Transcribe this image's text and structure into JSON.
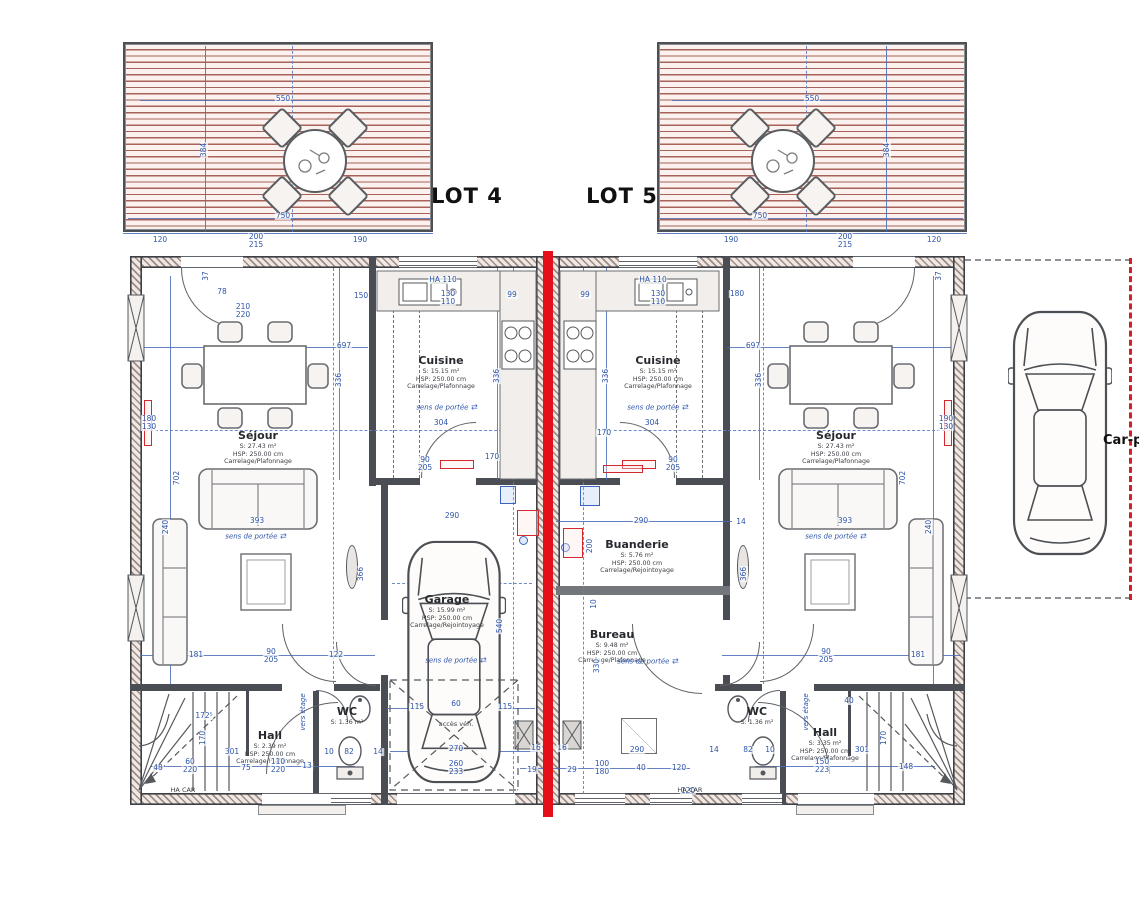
{
  "lots": [
    {
      "label": "LOT 4",
      "x": 467,
      "y": 196
    },
    {
      "label": "LOT 5",
      "x": 622,
      "y": 196
    }
  ],
  "carport": {
    "label": "Car-p",
    "x": 1103,
    "y": 433
  },
  "rooms": [
    {
      "name": "Séjour",
      "lines": [
        "S: 27.43 m²",
        "HSP: 250.00 cm",
        "Carrelage/Plafonnage"
      ],
      "x": 258,
      "y": 448
    },
    {
      "name": "Cuisine",
      "lines": [
        "S: 15.15 m²",
        "HSP: 250.00 cm",
        "Carrelage/Plafonnage"
      ],
      "x": 441,
      "y": 373
    },
    {
      "name": "Garage",
      "lines": [
        "S: 15.99 m²",
        "HSP: 250.00 cm",
        "Carrelage/Rejointoyage"
      ],
      "x": 447,
      "y": 612
    },
    {
      "name": "Hall",
      "lines": [
        "S: 2.39 m²",
        "HSP: 250.00 cm",
        "Carrelage/Plafonnage"
      ],
      "x": 270,
      "y": 748
    },
    {
      "name": "WC",
      "lines": [
        "S: 1.36 m²"
      ],
      "x": 347,
      "y": 716
    },
    {
      "name": "Cuisine",
      "lines": [
        "S: 15.15 m²",
        "HSP: 250.00 cm",
        "Carrelage/Plafonnage"
      ],
      "x": 658,
      "y": 373
    },
    {
      "name": "Buanderie",
      "lines": [
        "S: 5.76 m²",
        "HSP: 250.00 cm",
        "Carrelage/Rejointoyage"
      ],
      "x": 637,
      "y": 557
    },
    {
      "name": "Bureau",
      "lines": [
        "S: 9.48 m²",
        "HSP: 250.00 cm",
        "Carrelage/Plafonnage"
      ],
      "x": 612,
      "y": 647
    },
    {
      "name": "Séjour",
      "lines": [
        "S: 27.43 m²",
        "HSP: 250.00 cm",
        "Carrelage/Plafonnage"
      ],
      "x": 836,
      "y": 448
    },
    {
      "name": "WC",
      "lines": [
        "S: 1.36 m²"
      ],
      "x": 757,
      "y": 716
    },
    {
      "name": "Hall",
      "lines": [
        "S: 3.35 m²",
        "HSP: 250.00 cm",
        "Carrelage/Plafonnage"
      ],
      "x": 825,
      "y": 745
    }
  ],
  "dimensions": [
    {
      "t": "550",
      "x": 283,
      "y": 99
    },
    {
      "t": "750",
      "x": 283,
      "y": 216
    },
    {
      "t": "384",
      "x": 204,
      "y": 150,
      "v": 1
    },
    {
      "t": "120",
      "x": 160,
      "y": 240
    },
    {
      "t": "200",
      "t2": "215",
      "x": 256,
      "y": 241
    },
    {
      "t": "190",
      "x": 360,
      "y": 240
    },
    {
      "t": "550",
      "x": 812,
      "y": 99
    },
    {
      "t": "750",
      "x": 760,
      "y": 216
    },
    {
      "t": "384",
      "x": 887,
      "y": 150,
      "v": 1
    },
    {
      "t": "190",
      "x": 731,
      "y": 240
    },
    {
      "t": "200",
      "t2": "215",
      "x": 845,
      "y": 241
    },
    {
      "t": "120",
      "x": 934,
      "y": 240
    },
    {
      "t": "697",
      "x": 344,
      "y": 346
    },
    {
      "t": "697",
      "x": 753,
      "y": 346
    },
    {
      "t": "336",
      "x": 339,
      "y": 380,
      "v": 1
    },
    {
      "t": "336",
      "x": 497,
      "y": 376,
      "v": 1
    },
    {
      "t": "336",
      "x": 606,
      "y": 376,
      "v": 1
    },
    {
      "t": "336",
      "x": 759,
      "y": 380,
      "v": 1
    },
    {
      "t": "304",
      "x": 441,
      "y": 423
    },
    {
      "t": "304",
      "x": 652,
      "y": 423
    },
    {
      "t": "702",
      "x": 177,
      "y": 478,
      "v": 1
    },
    {
      "t": "702",
      "x": 903,
      "y": 478,
      "v": 1
    },
    {
      "t": "393",
      "x": 257,
      "y": 521
    },
    {
      "t": "393",
      "x": 845,
      "y": 521
    },
    {
      "t": "240",
      "x": 166,
      "y": 527,
      "v": 1
    },
    {
      "t": "240",
      "x": 929,
      "y": 527,
      "v": 1
    },
    {
      "t": "180",
      "t2": "130",
      "x": 149,
      "y": 423
    },
    {
      "t": "190",
      "t2": "130",
      "x": 946,
      "y": 423
    },
    {
      "t": "90",
      "t2": "205",
      "x": 271,
      "y": 656
    },
    {
      "t": "122",
      "x": 336,
      "y": 655
    },
    {
      "t": "181",
      "x": 196,
      "y": 655
    },
    {
      "t": "90",
      "t2": "205",
      "x": 826,
      "y": 656
    },
    {
      "t": "181",
      "x": 918,
      "y": 655
    },
    {
      "t": "290",
      "x": 452,
      "y": 516
    },
    {
      "t": "290",
      "x": 641,
      "y": 521
    },
    {
      "t": "540",
      "x": 500,
      "y": 626,
      "v": 1
    },
    {
      "t": "330",
      "x": 597,
      "y": 666,
      "v": 1
    },
    {
      "t": "115",
      "x": 417,
      "y": 707
    },
    {
      "t": "60",
      "x": 456,
      "y": 704
    },
    {
      "t": "115",
      "x": 505,
      "y": 707
    },
    {
      "t": "270",
      "x": 456,
      "y": 749
    },
    {
      "t": "260",
      "t2": "233",
      "x": 456,
      "y": 768
    },
    {
      "t": "16",
      "x": 536,
      "y": 748
    },
    {
      "t": "16",
      "x": 562,
      "y": 748
    },
    {
      "t": "19",
      "x": 532,
      "y": 770
    },
    {
      "t": "29",
      "x": 572,
      "y": 770
    },
    {
      "t": "100",
      "t2": "180",
      "x": 602,
      "y": 768
    },
    {
      "t": "40",
      "x": 641,
      "y": 768
    },
    {
      "t": "120",
      "x": 679,
      "y": 768
    },
    {
      "t": "290",
      "x": 637,
      "y": 750
    },
    {
      "t": "301",
      "x": 232,
      "y": 752
    },
    {
      "t": "110",
      "t2": "220",
      "x": 278,
      "y": 766
    },
    {
      "t": "75",
      "x": 246,
      "y": 768
    },
    {
      "t": "13",
      "x": 307,
      "y": 766
    },
    {
      "t": "10",
      "x": 329,
      "y": 752
    },
    {
      "t": "82",
      "x": 349,
      "y": 752
    },
    {
      "t": "14",
      "x": 378,
      "y": 752
    },
    {
      "t": "40",
      "x": 849,
      "y": 701
    },
    {
      "t": "301",
      "x": 862,
      "y": 750
    },
    {
      "t": "150",
      "t2": "223",
      "x": 822,
      "y": 766
    },
    {
      "t": "148",
      "x": 906,
      "y": 767
    },
    {
      "t": "14",
      "x": 714,
      "y": 750
    },
    {
      "t": "82",
      "x": 748,
      "y": 750
    },
    {
      "t": "10",
      "x": 770,
      "y": 750
    },
    {
      "t": "170",
      "x": 884,
      "y": 738,
      "v": 1
    },
    {
      "t": "170",
      "x": 203,
      "y": 738,
      "v": 1
    },
    {
      "t": "172⁵",
      "x": 204,
      "y": 716
    },
    {
      "t": "37",
      "x": 206,
      "y": 276,
      "v": 1
    },
    {
      "t": "37",
      "x": 939,
      "y": 276,
      "v": 1
    },
    {
      "t": "78",
      "x": 222,
      "y": 292
    },
    {
      "t": "210",
      "t2": "220",
      "x": 243,
      "y": 311
    },
    {
      "t": "150",
      "x": 361,
      "y": 296
    },
    {
      "t": "130",
      "t2": "110",
      "x": 448,
      "y": 298
    },
    {
      "t": "HA 110",
      "x": 443,
      "y": 280
    },
    {
      "t": "HA 110",
      "x": 653,
      "y": 280
    },
    {
      "t": "130",
      "t2": "110",
      "x": 658,
      "y": 298
    },
    {
      "t": "180",
      "x": 737,
      "y": 294
    },
    {
      "t": "99",
      "x": 512,
      "y": 295
    },
    {
      "t": "99",
      "x": 585,
      "y": 295
    },
    {
      "t": "170",
      "x": 492,
      "y": 457
    },
    {
      "t": "170",
      "x": 604,
      "y": 433
    },
    {
      "t": "90",
      "t2": "205",
      "x": 425,
      "y": 464
    },
    {
      "t": "90",
      "t2": "205",
      "x": 673,
      "y": 464
    },
    {
      "t": "366",
      "x": 361,
      "y": 574,
      "v": 1
    },
    {
      "t": "366",
      "x": 744,
      "y": 574,
      "v": 1
    },
    {
      "t": "14",
      "x": 741,
      "y": 522
    },
    {
      "t": "10",
      "x": 594,
      "y": 604,
      "v": 1
    },
    {
      "t": "200",
      "x": 590,
      "y": 546,
      "v": 1
    },
    {
      "t": "60",
      "t2": "220",
      "x": 190,
      "y": 766
    },
    {
      "t": "48",
      "x": 158,
      "y": 768
    },
    {
      "t": "120",
      "x": 688,
      "y": 791
    }
  ],
  "annotations": [
    {
      "t": "sens de portée",
      "x": 256,
      "y": 536,
      "k": "note"
    },
    {
      "t": "sens de portée",
      "x": 447,
      "y": 407,
      "k": "note"
    },
    {
      "t": "sens de portée",
      "x": 658,
      "y": 407,
      "k": "note"
    },
    {
      "t": "sens de portée",
      "x": 456,
      "y": 660,
      "k": "note"
    },
    {
      "t": "sens de portée",
      "x": 648,
      "y": 661,
      "k": "note"
    },
    {
      "t": "sens de portée",
      "x": 836,
      "y": 536,
      "k": "note"
    },
    {
      "t": "vers étage",
      "x": 303,
      "y": 712,
      "v": 1,
      "k": "note"
    },
    {
      "t": "vers étage",
      "x": 806,
      "y": 712,
      "v": 1,
      "k": "note"
    },
    {
      "t": "HA CAR",
      "x": 183,
      "y": 790,
      "k": "tag"
    },
    {
      "t": "HA CAR",
      "x": 690,
      "y": 790,
      "k": "tag"
    },
    {
      "t": "accès véh.",
      "x": 456,
      "y": 724,
      "k": "tag"
    }
  ],
  "radiators": [
    {
      "x": 144,
      "y": 400,
      "w": 8,
      "h": 46
    },
    {
      "x": 944,
      "y": 400,
      "w": 8,
      "h": 46
    },
    {
      "x": 440,
      "y": 460,
      "w": 34,
      "h": 9
    },
    {
      "x": 622,
      "y": 460,
      "w": 34,
      "h": 9
    },
    {
      "x": 517,
      "y": 510,
      "w": 22,
      "h": 26
    },
    {
      "x": 563,
      "y": 528,
      "w": 20,
      "h": 30
    },
    {
      "x": 603,
      "y": 465,
      "w": 40,
      "h": 8
    }
  ],
  "colors": {
    "separation_red": "#e50f1a",
    "dimension_blue": "#2d54a8",
    "wall_dark": "#3c4044",
    "terrace_stripe": "#a9625a",
    "carport_dash_red": "#d32027"
  }
}
